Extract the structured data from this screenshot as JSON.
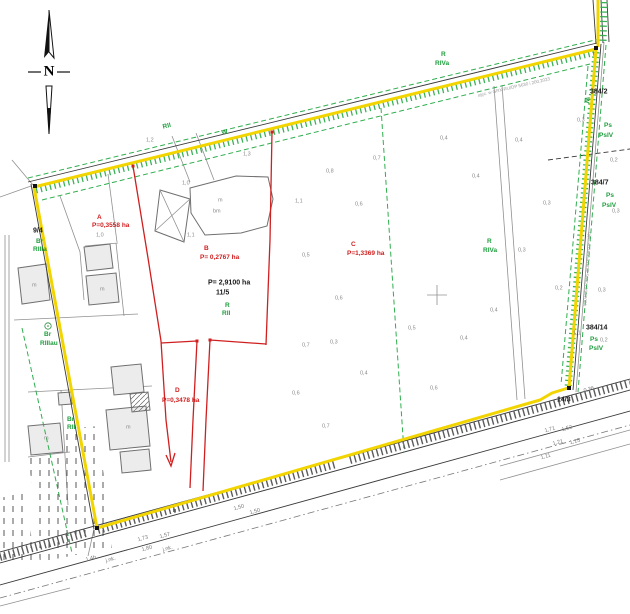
{
  "colors": {
    "boundary_yellow": "#f2d500",
    "parcel_red": "#d01f1f",
    "landuse_green": "#2fae4e",
    "line_gray": "#909090",
    "line_dark": "#3a3a3a",
    "road_hatch": "#5a5a5a"
  },
  "north": {
    "label": "N"
  },
  "parcels": {
    "A": {
      "label": "A",
      "area": "P=0,3558 ha"
    },
    "B": {
      "label": "B",
      "area": "P= 0,2767 ha"
    },
    "C": {
      "label": "C",
      "area": "P=1,3369 ha"
    },
    "D": {
      "label": "D",
      "area": "P=0,3478 ha"
    },
    "main": {
      "number": "11/5",
      "area": "P= 2,9100 ha"
    },
    "neighbors": [
      "9/4",
      "384/2",
      "384/7",
      "384/14",
      "14/3"
    ]
  },
  "labels": [
    {
      "t": "N",
      "x": 49,
      "y": 72,
      "c": "north"
    },
    {
      "t": "A",
      "x": 97,
      "y": 218,
      "c": "red"
    },
    {
      "t": "P=0,3558 ha",
      "x": 92,
      "y": 226,
      "c": "red"
    },
    {
      "t": "B",
      "x": 204,
      "y": 249,
      "c": "red"
    },
    {
      "t": "P= 0,2767 ha",
      "x": 200,
      "y": 258,
      "c": "red"
    },
    {
      "t": "C",
      "x": 351,
      "y": 245,
      "c": "red"
    },
    {
      "t": "P=1,3369 ha",
      "x": 347,
      "y": 254,
      "c": "red"
    },
    {
      "t": "D",
      "x": 175,
      "y": 391,
      "c": "red"
    },
    {
      "t": "P=0,3478 ha",
      "x": 162,
      "y": 401,
      "c": "red"
    },
    {
      "t": "P= 2,9100 ha",
      "x": 208,
      "y": 283,
      "c": "black"
    },
    {
      "t": "11/5",
      "x": 216,
      "y": 293,
      "c": "black"
    },
    {
      "t": "9/4",
      "x": 33,
      "y": 231,
      "c": "black"
    },
    {
      "t": "384/2",
      "x": 590,
      "y": 92,
      "c": "black"
    },
    {
      "t": "384/7",
      "x": 591,
      "y": 183,
      "c": "black"
    },
    {
      "t": "384/14",
      "x": 586,
      "y": 328,
      "c": "black"
    },
    {
      "t": "14/3",
      "x": 557,
      "y": 400,
      "c": "black"
    },
    {
      "t": "R",
      "x": 441,
      "y": 55,
      "c": "green"
    },
    {
      "t": "RIVa",
      "x": 435,
      "y": 64,
      "c": "green"
    },
    {
      "t": "RII",
      "x": 163,
      "y": 128,
      "c": "green",
      "r": -14
    },
    {
      "t": "W",
      "x": 222,
      "y": 134,
      "c": "green",
      "r": -14
    },
    {
      "t": "W",
      "x": 586,
      "y": 97,
      "c": "green",
      "r": 95
    },
    {
      "t": "R",
      "x": 225,
      "y": 306,
      "c": "green"
    },
    {
      "t": "RII",
      "x": 222,
      "y": 314,
      "c": "green"
    },
    {
      "t": "R",
      "x": 487,
      "y": 242,
      "c": "green"
    },
    {
      "t": "RIVa",
      "x": 483,
      "y": 251,
      "c": "green"
    },
    {
      "t": "Ps",
      "x": 604,
      "y": 126,
      "c": "green"
    },
    {
      "t": "PsIV",
      "x": 599,
      "y": 136,
      "c": "green"
    },
    {
      "t": "Ps",
      "x": 606,
      "y": 196,
      "c": "green"
    },
    {
      "t": "PsIV",
      "x": 602,
      "y": 206,
      "c": "green"
    },
    {
      "t": "Ps",
      "x": 590,
      "y": 340,
      "c": "green"
    },
    {
      "t": "PsIV",
      "x": 589,
      "y": 349,
      "c": "green"
    },
    {
      "t": "Br",
      "x": 36,
      "y": 242,
      "c": "green"
    },
    {
      "t": "RIIIa",
      "x": 33,
      "y": 250,
      "c": "green"
    },
    {
      "t": "Br",
      "x": 44,
      "y": 335,
      "c": "green"
    },
    {
      "t": "RIIIau",
      "x": 40,
      "y": 344,
      "c": "green"
    },
    {
      "t": "Br",
      "x": 67,
      "y": 420,
      "c": "green"
    },
    {
      "t": "RII",
      "x": 67,
      "y": 428,
      "c": "green"
    },
    {
      "t": "m",
      "x": 32,
      "y": 286,
      "c": "gray"
    },
    {
      "t": "m",
      "x": 100,
      "y": 290,
      "c": "gray"
    },
    {
      "t": "m",
      "x": 44,
      "y": 439,
      "c": "gray"
    },
    {
      "t": "m",
      "x": 126,
      "y": 428,
      "c": "gray"
    },
    {
      "t": "m",
      "x": 218,
      "y": 201,
      "c": "gray"
    },
    {
      "t": "bm",
      "x": 213,
      "y": 212,
      "c": "gray"
    },
    {
      "t": "1,0",
      "x": 96,
      "y": 236,
      "c": "gray"
    },
    {
      "t": "1,2",
      "x": 146,
      "y": 141,
      "c": "gray"
    },
    {
      "t": "1,3",
      "x": 243,
      "y": 155,
      "c": "gray"
    },
    {
      "t": "1,0",
      "x": 182,
      "y": 184,
      "c": "gray"
    },
    {
      "t": "1,1",
      "x": 187,
      "y": 236,
      "c": "gray"
    },
    {
      "t": "0,8",
      "x": 326,
      "y": 172,
      "c": "gray"
    },
    {
      "t": "0,7",
      "x": 373,
      "y": 159,
      "c": "gray"
    },
    {
      "t": "0,6",
      "x": 355,
      "y": 205,
      "c": "gray"
    },
    {
      "t": "1,1",
      "x": 295,
      "y": 202,
      "c": "gray"
    },
    {
      "t": "0,4",
      "x": 440,
      "y": 139,
      "c": "gray"
    },
    {
      "t": "0,4",
      "x": 515,
      "y": 141,
      "c": "gray"
    },
    {
      "t": "0,4",
      "x": 472,
      "y": 177,
      "c": "gray"
    },
    {
      "t": "0,3",
      "x": 543,
      "y": 204,
      "c": "gray"
    },
    {
      "t": "0,3",
      "x": 518,
      "y": 251,
      "c": "gray"
    },
    {
      "t": "0,5",
      "x": 302,
      "y": 256,
      "c": "gray"
    },
    {
      "t": "0,6",
      "x": 335,
      "y": 299,
      "c": "gray"
    },
    {
      "t": "0,7",
      "x": 302,
      "y": 346,
      "c": "gray"
    },
    {
      "t": "0,3",
      "x": 330,
      "y": 343,
      "c": "gray"
    },
    {
      "t": "0,6",
      "x": 292,
      "y": 394,
      "c": "gray"
    },
    {
      "t": "0,7",
      "x": 322,
      "y": 427,
      "c": "gray"
    },
    {
      "t": "0,4",
      "x": 360,
      "y": 374,
      "c": "gray"
    },
    {
      "t": "0,5",
      "x": 408,
      "y": 329,
      "c": "gray"
    },
    {
      "t": "0,6",
      "x": 430,
      "y": 389,
      "c": "gray"
    },
    {
      "t": "0,4",
      "x": 460,
      "y": 339,
      "c": "gray"
    },
    {
      "t": "0,4",
      "x": 490,
      "y": 311,
      "c": "gray"
    },
    {
      "t": "0,2",
      "x": 555,
      "y": 289,
      "c": "gray"
    },
    {
      "t": "0,3",
      "x": 598,
      "y": 291,
      "c": "gray"
    },
    {
      "t": "0,2",
      "x": 610,
      "y": 161,
      "c": "gray"
    },
    {
      "t": "0,3",
      "x": 612,
      "y": 212,
      "c": "gray"
    },
    {
      "t": "0,3",
      "x": 577,
      "y": 121,
      "c": "gray"
    },
    {
      "t": "1,1",
      "x": 573,
      "y": 334,
      "c": "gray"
    },
    {
      "t": "0,2",
      "x": 600,
      "y": 341,
      "c": "gray"
    },
    {
      "t": "1,73",
      "x": 138,
      "y": 541,
      "c": "dim",
      "r": -15
    },
    {
      "t": "1,57",
      "x": 160,
      "y": 538,
      "c": "dim",
      "r": -15
    },
    {
      "t": "1,50",
      "x": 234,
      "y": 510,
      "c": "dim",
      "r": -15
    },
    {
      "t": "1,50",
      "x": 250,
      "y": 514,
      "c": "dim",
      "r": -15
    },
    {
      "t": "1,80",
      "x": 142,
      "y": 551,
      "c": "dim",
      "r": -15
    },
    {
      "t": "j.nk.",
      "x": 163,
      "y": 551,
      "c": "dim",
      "r": -15
    },
    {
      "t": "1,4b",
      "x": 86,
      "y": 561,
      "c": "dim",
      "r": -15
    },
    {
      "t": "j.nk.",
      "x": 106,
      "y": 562,
      "c": "dim",
      "r": -15
    },
    {
      "t": "1,71",
      "x": 545,
      "y": 432,
      "c": "dim",
      "r": -15
    },
    {
      "t": "1,52",
      "x": 562,
      "y": 431,
      "c": "dim",
      "r": -15
    },
    {
      "t": "1,21",
      "x": 553,
      "y": 445,
      "c": "dim",
      "r": -15
    },
    {
      "t": "1,15",
      "x": 570,
      "y": 444,
      "c": "dim",
      "r": -15
    },
    {
      "t": "1,11",
      "x": 541,
      "y": 459,
      "c": "dim",
      "r": -15
    },
    {
      "t": "0,36",
      "x": 584,
      "y": 392,
      "c": "dim",
      "r": -15
    },
    {
      "t": "ujęc. w GRX-RU/DP 5630 i 200.2023",
      "x": 478,
      "y": 96,
      "c": "tiny",
      "r": -13
    },
    {
      "t": "ujęc. w GRX-RU/DP 5630 i 200.2023",
      "x": 589,
      "y": 232,
      "c": "tiny",
      "r": 94
    }
  ]
}
